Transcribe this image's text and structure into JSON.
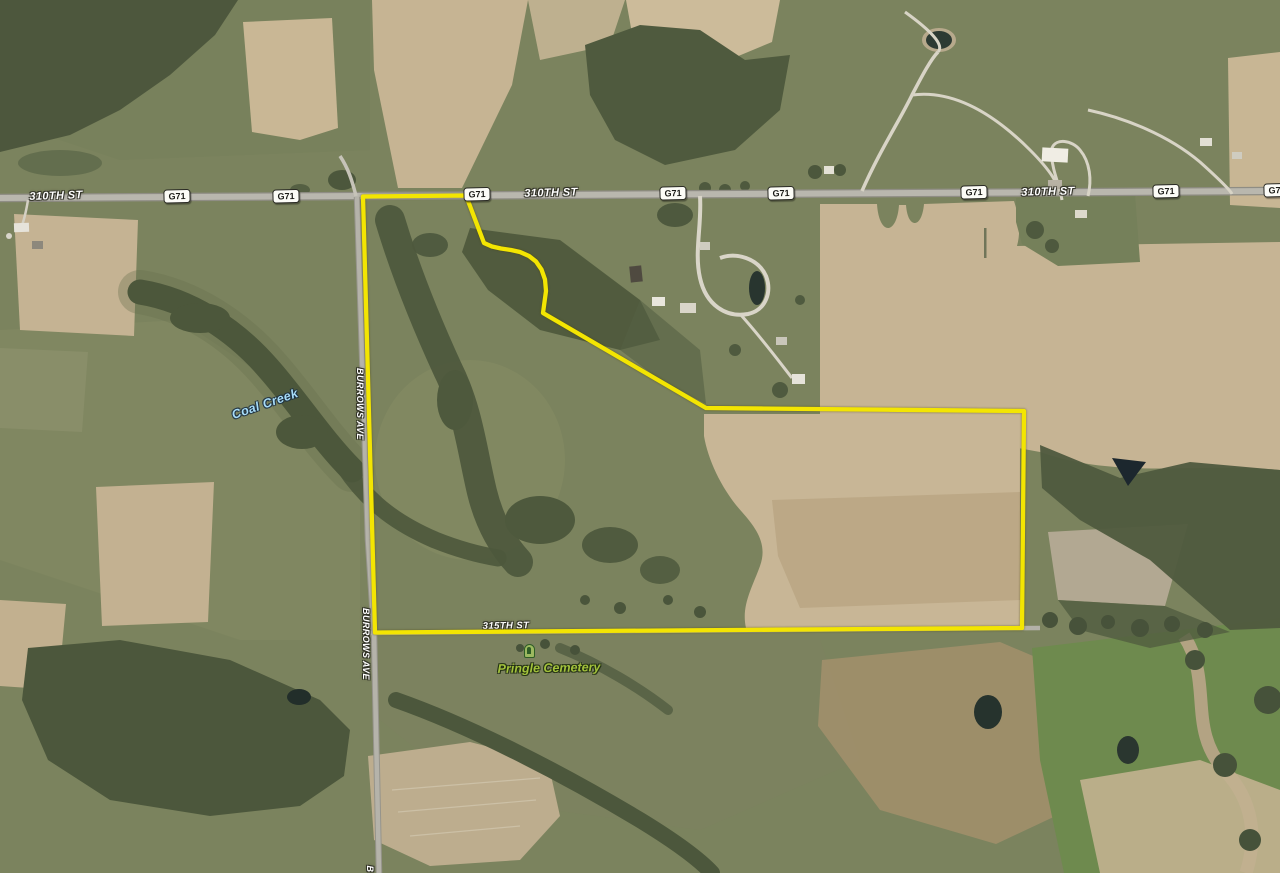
{
  "map": {
    "view": "aerial-satellite",
    "streets": [
      {
        "text": "310TH ST",
        "x": 56,
        "y": 196,
        "rotate": -2,
        "size": 11
      },
      {
        "text": "310TH ST",
        "x": 551,
        "y": 193,
        "rotate": -1.5,
        "size": 11
      },
      {
        "text": "310TH ST",
        "x": 1048,
        "y": 192,
        "rotate": -1.5,
        "size": 11
      },
      {
        "text": "315TH ST",
        "x": 506,
        "y": 626,
        "rotate": -1,
        "size": 9.5,
        "covered": true
      },
      {
        "text": "BURROWS AVE",
        "x": 360,
        "y": 404,
        "rotate": 90,
        "size": 9
      },
      {
        "text": "BURROWS AVE",
        "x": 366,
        "y": 644,
        "rotate": 90,
        "size": 9
      },
      {
        "text": "B",
        "x": 370,
        "y": 869,
        "rotate": 90,
        "size": 9
      }
    ],
    "route_shields": [
      {
        "text": "G71",
        "x": 177,
        "y": 196
      },
      {
        "text": "G71",
        "x": 286,
        "y": 195.5
      },
      {
        "text": "G71",
        "x": 477,
        "y": 194
      },
      {
        "text": "G71",
        "x": 673,
        "y": 193
      },
      {
        "text": "G71",
        "x": 781,
        "y": 192.5
      },
      {
        "text": "G71",
        "x": 974,
        "y": 191.5
      },
      {
        "text": "G71",
        "x": 1166,
        "y": 190.5
      },
      {
        "text": "G71",
        "x": 1277,
        "y": 190
      }
    ],
    "places": {
      "creek": {
        "label": "Coal Creek"
      },
      "cemetery": {
        "label": "Pringle Cemetery"
      }
    },
    "parcel": {
      "outline_color": "#f3e502"
    },
    "colors": {
      "street_label": "#ffffff",
      "creek_label": "#a7dcf8",
      "cemetery_label": "#a3c23c",
      "shield_bg": "#fcfcf7",
      "shield_border": "#2a2a24",
      "shield_text": "#1a1a16"
    }
  }
}
